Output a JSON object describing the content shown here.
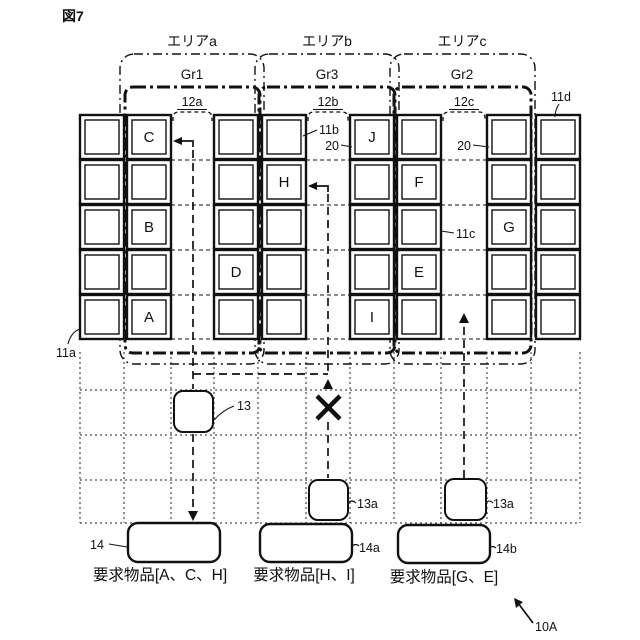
{
  "figure_label": "図7",
  "system_ref": "10A",
  "areas": [
    {
      "area_label": "エリアa",
      "group_label": "Gr1",
      "aisle_label": "12a"
    },
    {
      "area_label": "エリアb",
      "group_label": "Gr3",
      "aisle_label": "12b"
    },
    {
      "area_label": "エリアc",
      "group_label": "Gr2",
      "aisle_label": "12c"
    }
  ],
  "rack_refs": {
    "left": "11a",
    "center_left": "11b",
    "center_right": "11c",
    "right": "11d"
  },
  "storage_section_refs": {
    "gr3": "20",
    "gr2": "20"
  },
  "rack_columns": [
    {
      "letters": {}
    },
    {
      "letters": {
        "1": "C",
        "3": "B",
        "5": "A"
      }
    },
    {
      "letters": {
        "4": "D"
      }
    },
    {
      "letters": {
        "2": "H"
      }
    },
    {
      "letters": {
        "1": "J",
        "5": "I"
      }
    },
    {
      "letters": {
        "2": "F",
        "4": "E"
      }
    },
    {
      "letters": {
        "3": "G"
      }
    },
    {
      "letters": {}
    }
  ],
  "robots": {
    "main": "13",
    "blocked": "13a",
    "active": "13a"
  },
  "stations": [
    {
      "ref": "14",
      "request": "要求物品[A、C、H]"
    },
    {
      "ref": "14a",
      "request": "要求物品[H、I]"
    },
    {
      "ref": "14b",
      "request": "要求物品[G、E]"
    }
  ]
}
